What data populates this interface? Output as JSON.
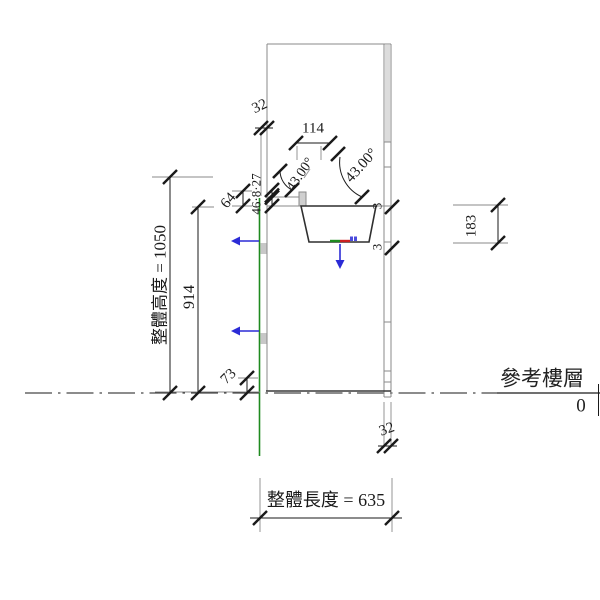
{
  "drawing": {
    "type": "cad-elevation-view",
    "background": "#ffffff",
    "colors": {
      "geometry_gray": "#8a8a8a",
      "sink_outline": "#2f2f2f",
      "dimension_black": "#1a1a1a",
      "reference_plane_green": "#1f8a1f",
      "control_blue": "#2b2bd6",
      "origin_red": "#cc2020",
      "panel_fill": "#dcdcdc"
    },
    "dimensions": {
      "overall_height": "整體高度 = 1050",
      "counter_height": "914",
      "backsplash_height": "64",
      "toekick_height": "73",
      "front_offset": "32",
      "faucet_width": "114",
      "stacked_small": "46·8·27",
      "angle_left": "43.00°",
      "angle_right": "43.00°",
      "sink_depth": "183",
      "gap_upper": "3",
      "gap_lower": "3",
      "back_panel_width": "32",
      "overall_length": "整體長度 = 635"
    },
    "level": {
      "name": "參考樓層",
      "elevation": "0"
    }
  }
}
